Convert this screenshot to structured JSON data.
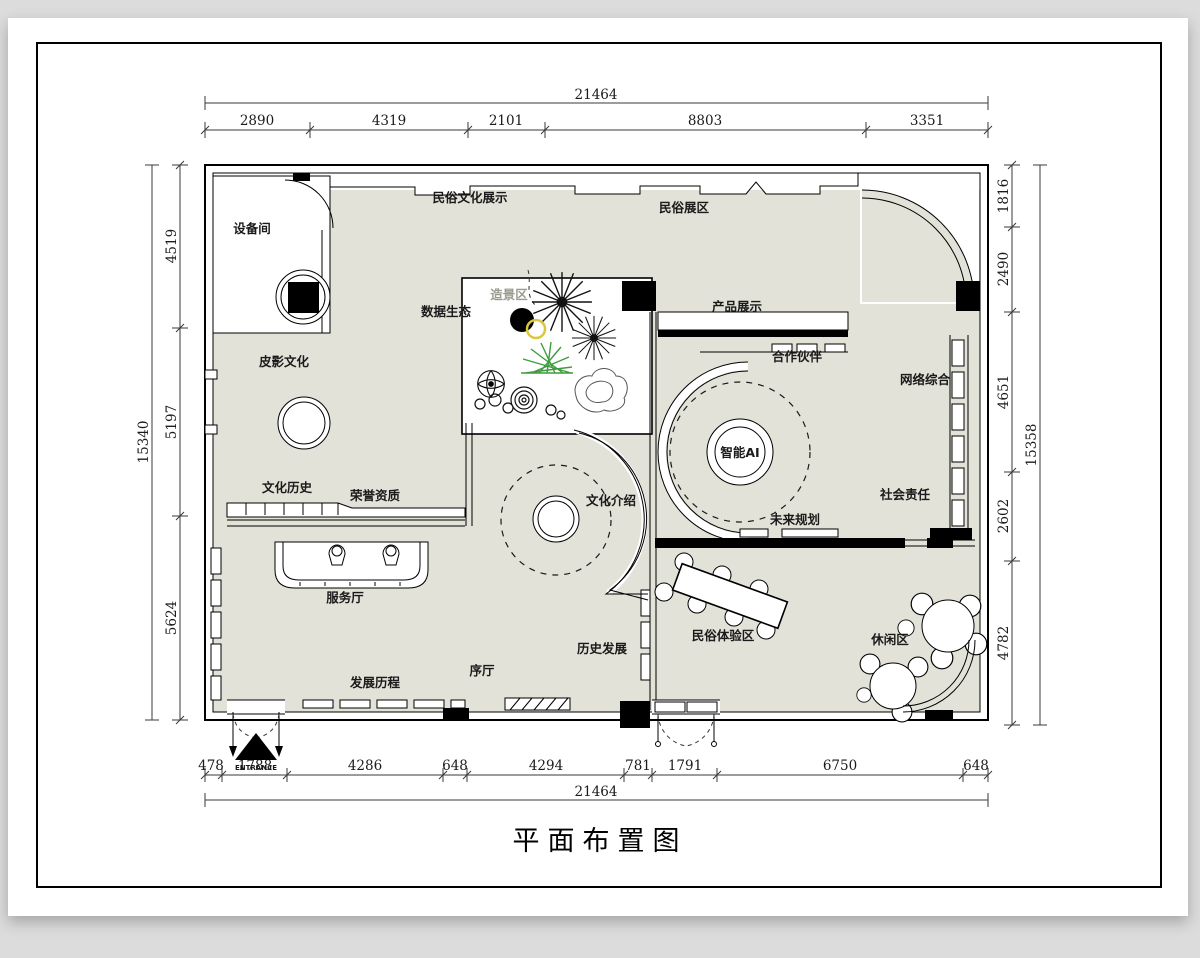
{
  "page": {
    "title": "平面布置图"
  },
  "plan": {
    "rooms": {
      "equipment": "设备间",
      "folk_culture_display": "民俗文化展示",
      "folk_zone": "民俗展区",
      "landscape": "造景区",
      "data_ecology": "数据生态",
      "product_display": "产品展示",
      "partners": "合作伙伴",
      "network": "网络综合",
      "shadow_puppet": "皮影文化",
      "ai": "智能AI",
      "social_responsibility": "社会责任",
      "culture_history": "文化历史",
      "honors": "荣誉资质",
      "culture_intro": "文化介绍",
      "future_plan": "未来规划",
      "service_hall": "服务厅",
      "development_history": "发展历程",
      "prologue_hall": "序厅",
      "history_development": "历史发展",
      "folk_experience": "民俗体验区",
      "leisure": "休闲区"
    },
    "entrance_label": "ENTRANCE",
    "dimensions": {
      "top": {
        "total": "21464",
        "segments": [
          "2890",
          "4319",
          "2101",
          "8803",
          "3351"
        ]
      },
      "bottom": {
        "total": "21464",
        "segments": [
          "478",
          "1788",
          "4286",
          "648",
          "4294",
          "781",
          "1791",
          "6750",
          "648"
        ]
      },
      "left": {
        "total": "15340",
        "segments": [
          "4519",
          "5197",
          "5624"
        ]
      },
      "right": {
        "total": "15358",
        "segments": [
          "1816",
          "2490",
          "4651",
          "2602",
          "4782"
        ]
      }
    },
    "colors": {
      "floor": "#e2e2d8",
      "wall": "#000000",
      "plant_green": "#3f9b3f",
      "plant_yellow": "#d8c83a"
    }
  }
}
